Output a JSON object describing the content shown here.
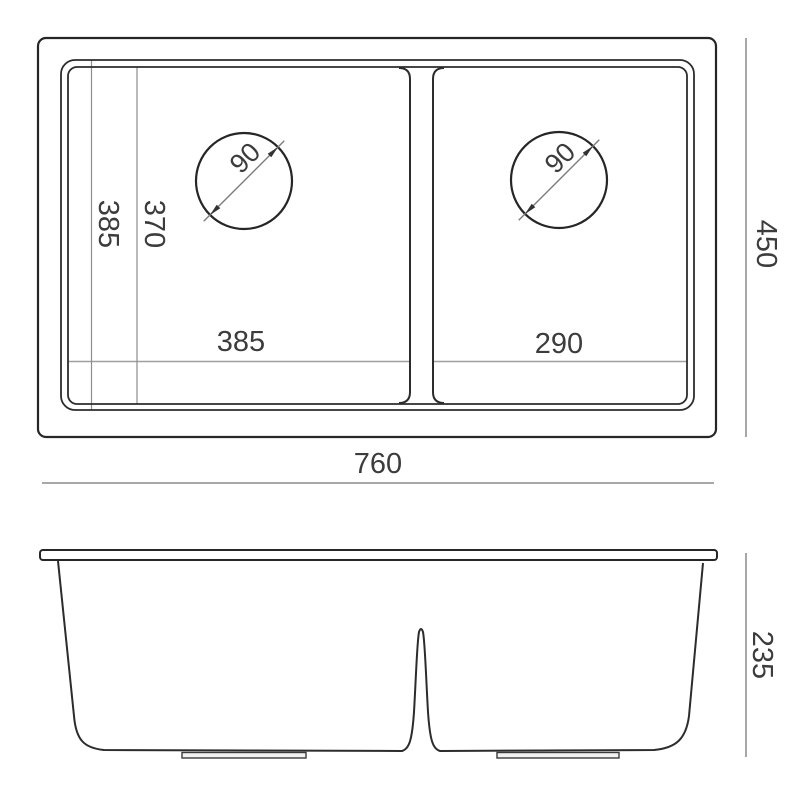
{
  "drawing": {
    "type": "technical-drawing",
    "subject": "double-bowl undermount sink, top view and front section view",
    "colors": {
      "background": "#ffffff",
      "outline": "#2a2a2a",
      "dimension_line": "#9c9c9c",
      "extension_line": "#8d8d8d",
      "text": "#3c3c3c"
    },
    "top_view": {
      "overall_width_label": "760",
      "overall_depth_label": "450",
      "bowl_outer_depth_label": "385",
      "bowl_inner_depth_label": "370",
      "left_bowl_width_label": "385",
      "right_bowl_width_label": "290",
      "left_drain_diameter_label": "90",
      "right_drain_diameter_label": "90"
    },
    "front_view": {
      "overall_height_label": "235"
    }
  }
}
